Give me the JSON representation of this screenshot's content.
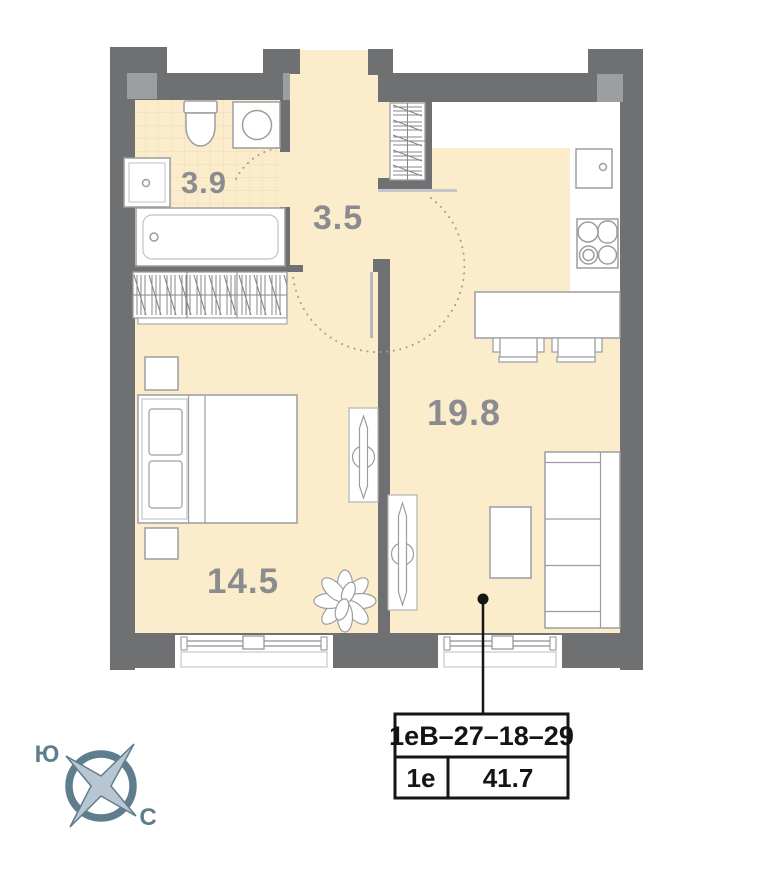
{
  "plan": {
    "rooms": [
      {
        "id": "bathroom",
        "area": "3.9"
      },
      {
        "id": "hallway",
        "area": "3.5"
      },
      {
        "id": "living-kitchen",
        "area": "19.8"
      },
      {
        "id": "bedroom",
        "area": "14.5"
      }
    ],
    "unit_card": {
      "layout_code": "1еВ–27–18–29",
      "unit_type": "1е",
      "total_area": "41.7"
    },
    "compass": {
      "south_label": "Ю",
      "north_label": "С"
    },
    "colors": {
      "wall": "#6f7072",
      "wall_light": "#9d9ea0",
      "floor": "#fbeccb",
      "tile_line": "#eedbb3",
      "furniture_stroke": "#9b9da0",
      "room_label": "#8a8c8f",
      "marker_black": "#151515",
      "compass_main": "#5f7d8d",
      "compass_star_fill": "#b7c6d0"
    }
  }
}
